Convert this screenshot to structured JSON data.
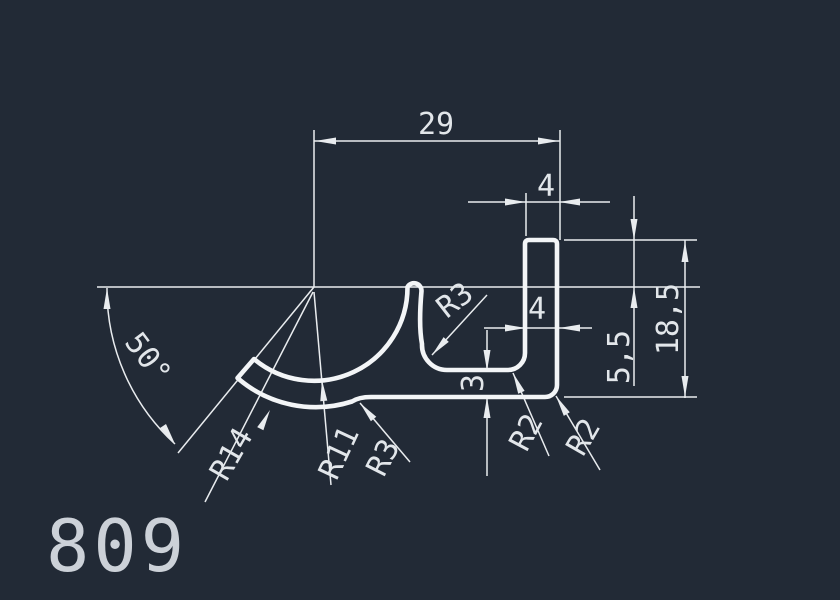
{
  "colors": {
    "background": "#222a36",
    "line": "#e9ecef",
    "profile_line": "#f3f5f7",
    "text": "#e2e6ea",
    "part_number_text": "#ccd1d8"
  },
  "part_number": "809",
  "dimensions": {
    "overall_width": "29",
    "leg_top_width": "4",
    "leg_width": "4",
    "bottom_wall_thickness": "3",
    "leg_height_above_datum": "5,5",
    "overall_height": "18,5",
    "arm_angle": "50°"
  },
  "radii": {
    "arm_outer_radius": "R14",
    "arm_inner_radius": "R11",
    "arm_root_fillet": "R3",
    "horn_base_fillet": "R3",
    "pocket_inner_fillet": "R2",
    "bottom_corner_fillet": "R2"
  }
}
